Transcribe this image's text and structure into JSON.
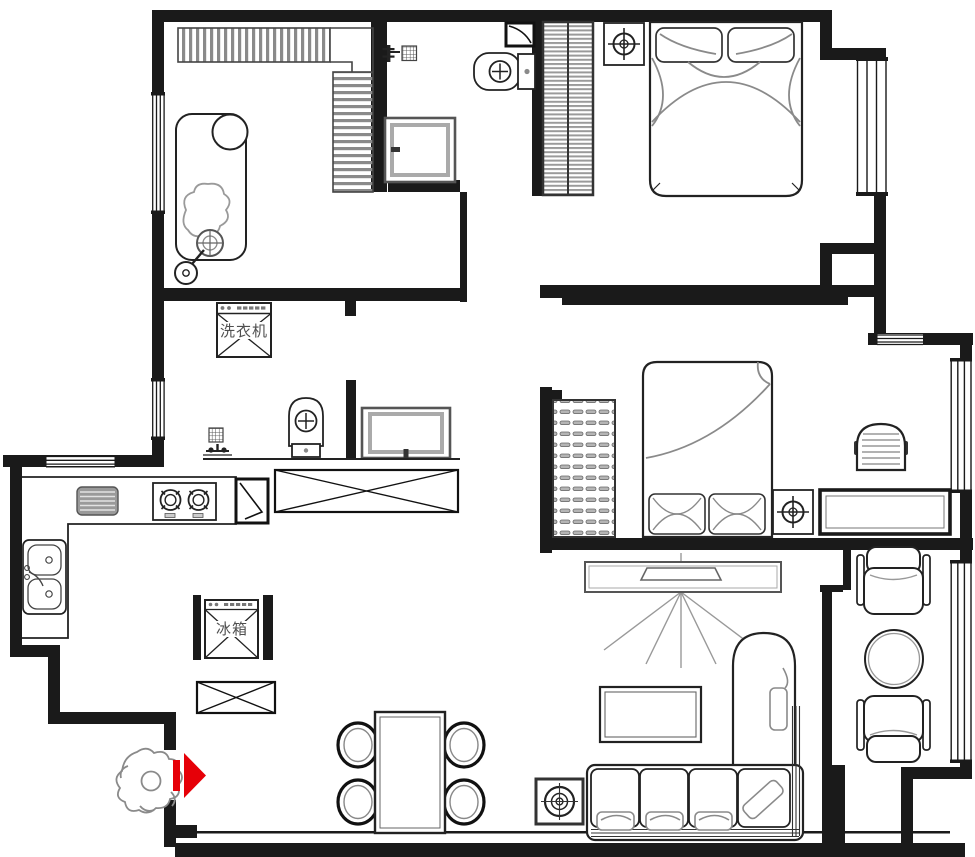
{
  "labels": {
    "washing_machine": "洗衣机",
    "refrigerator": "冰箱"
  },
  "colors": {
    "wall": "#1a1a1a",
    "furniture_line": "#222222",
    "soft_detail": "#8a8a8a",
    "accent_red": "#e60008",
    "label_text": "#4f4f4f"
  },
  "rooms": [
    {
      "name": "cloakroom",
      "fixtures": [
        "l-shaped-wardrobe",
        "lounge-chair",
        "clothes-pile",
        "floor-lamp"
      ]
    },
    {
      "name": "bathroom",
      "fixtures": [
        "shower-fixture",
        "floor-drain",
        "door-leaf",
        "toilet",
        "vanity-cabinet"
      ]
    },
    {
      "name": "master-bedroom",
      "fixtures": [
        "sliding-wardrobe",
        "nightstand",
        "lamp",
        "double-bed",
        "bay-window"
      ]
    },
    {
      "name": "laundry-bathroom",
      "fixtures": [
        "washing-machine",
        "floor-drain",
        "tap",
        "toilet",
        "vanity-cabinet",
        "counter"
      ]
    },
    {
      "name": "kitchen",
      "fixtures": [
        "l-counter",
        "drainboard",
        "gas-stove",
        "double-sink",
        "door-leaf",
        "refrigerator",
        "cabinet"
      ]
    },
    {
      "name": "second-bedroom",
      "fixtures": [
        "shelf-wardrobe",
        "double-bed",
        "nightstand",
        "lamp",
        "desk",
        "desk-chair",
        "bay-window"
      ]
    },
    {
      "name": "living-dining",
      "fixtures": [
        "tv-cabinet",
        "tv",
        "dining-table",
        "dining-chairs",
        "air-conditioner",
        "corner-sofa",
        "coffee-table",
        "armchairs",
        "round-table"
      ]
    },
    {
      "name": "entrance",
      "fixtures": [
        "person-figure",
        "entry-arrow",
        "shoe-cabinet"
      ]
    }
  ]
}
